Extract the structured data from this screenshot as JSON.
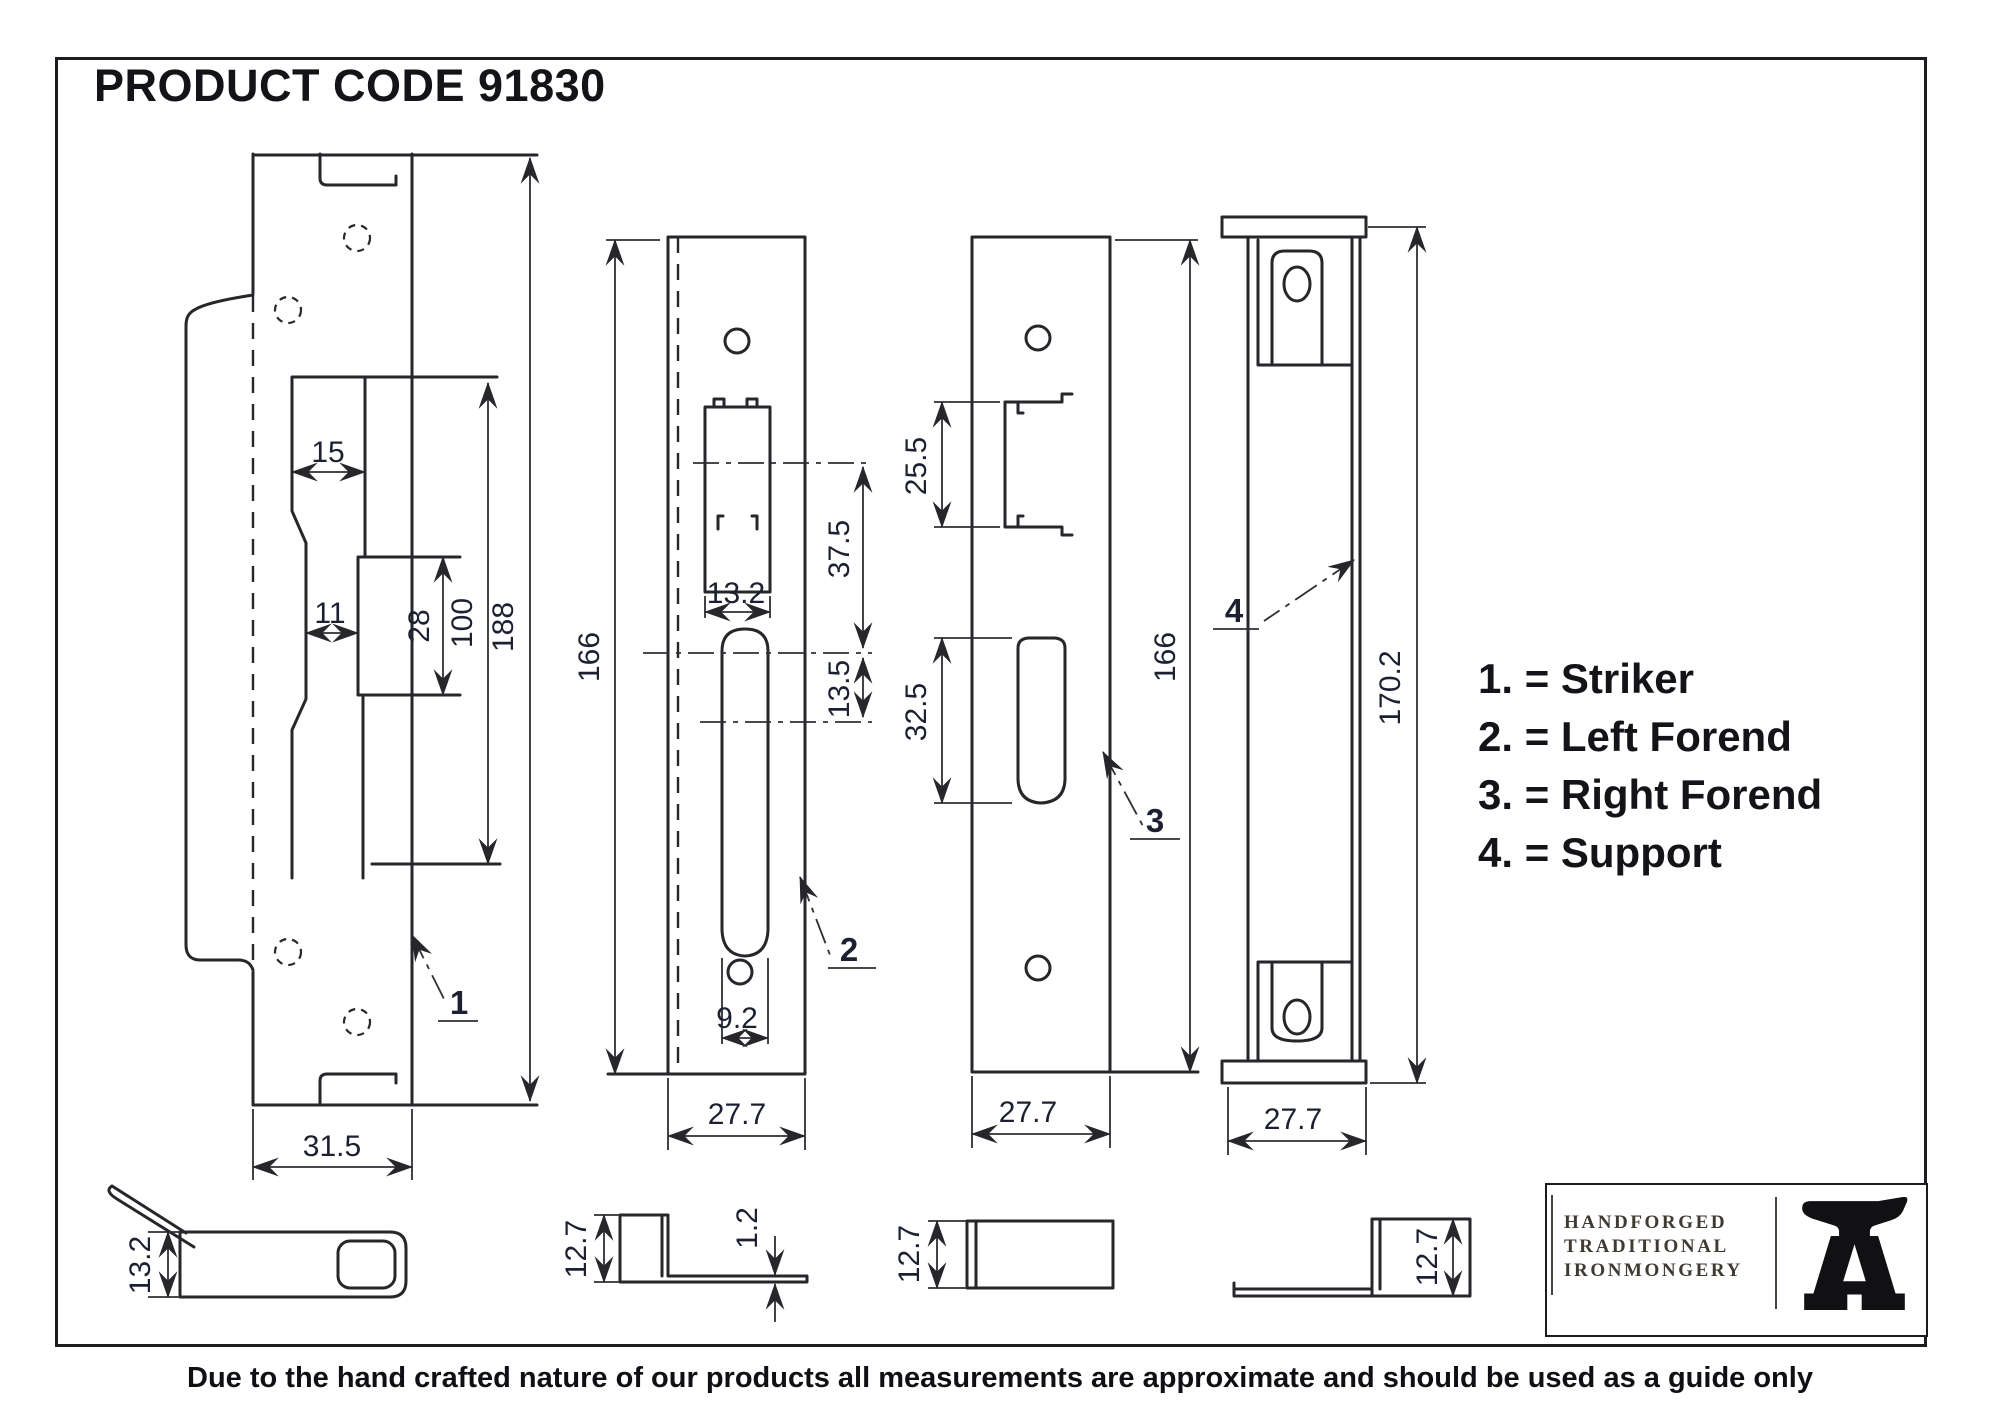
{
  "title": "PRODUCT CODE 91830",
  "legend": {
    "items": [
      {
        "label": "1. = Striker"
      },
      {
        "label": "2. = Left Forend"
      },
      {
        "label": "3. = Right Forend"
      },
      {
        "label": "4. = Support"
      }
    ]
  },
  "drawings": {
    "striker": {
      "part_no": "1",
      "dims": {
        "cutout_top_width": "15",
        "slot_width": "11",
        "bolt_cutout_height": "28",
        "cutout_length": "100",
        "plate_height": "188",
        "plate_width": "31.5",
        "side_height": "13.2"
      }
    },
    "left_forend": {
      "part_no": "2",
      "dims": {
        "plate_height": "166",
        "latch_cutout_width": "13.2",
        "latch_centre_offset": "37.5",
        "bolt_centre_offset": "13.5",
        "bolt_slot_width": "9.2",
        "plate_width": "27.7",
        "lip_height": "12.7",
        "thickness": "1.2"
      }
    },
    "right_forend": {
      "part_no": "3",
      "dims": {
        "plate_height": "166",
        "latch_cutout_height": "25.5",
        "bolt_cutout_height": "32.5",
        "plate_width": "27.7",
        "lip_height": "12.7"
      }
    },
    "support": {
      "part_no": "4",
      "dims": {
        "height": "170.2",
        "width": "27.7",
        "lip_height": "12.7"
      }
    }
  },
  "logo": {
    "line1": "HANDFORGED",
    "line2": "TRADITIONAL",
    "line3": "IRONMONGERY",
    "icon": "anvil-icon"
  },
  "disclaimer": "Due to the hand crafted nature of our products all measurements are approximate and should be used as a guide only"
}
